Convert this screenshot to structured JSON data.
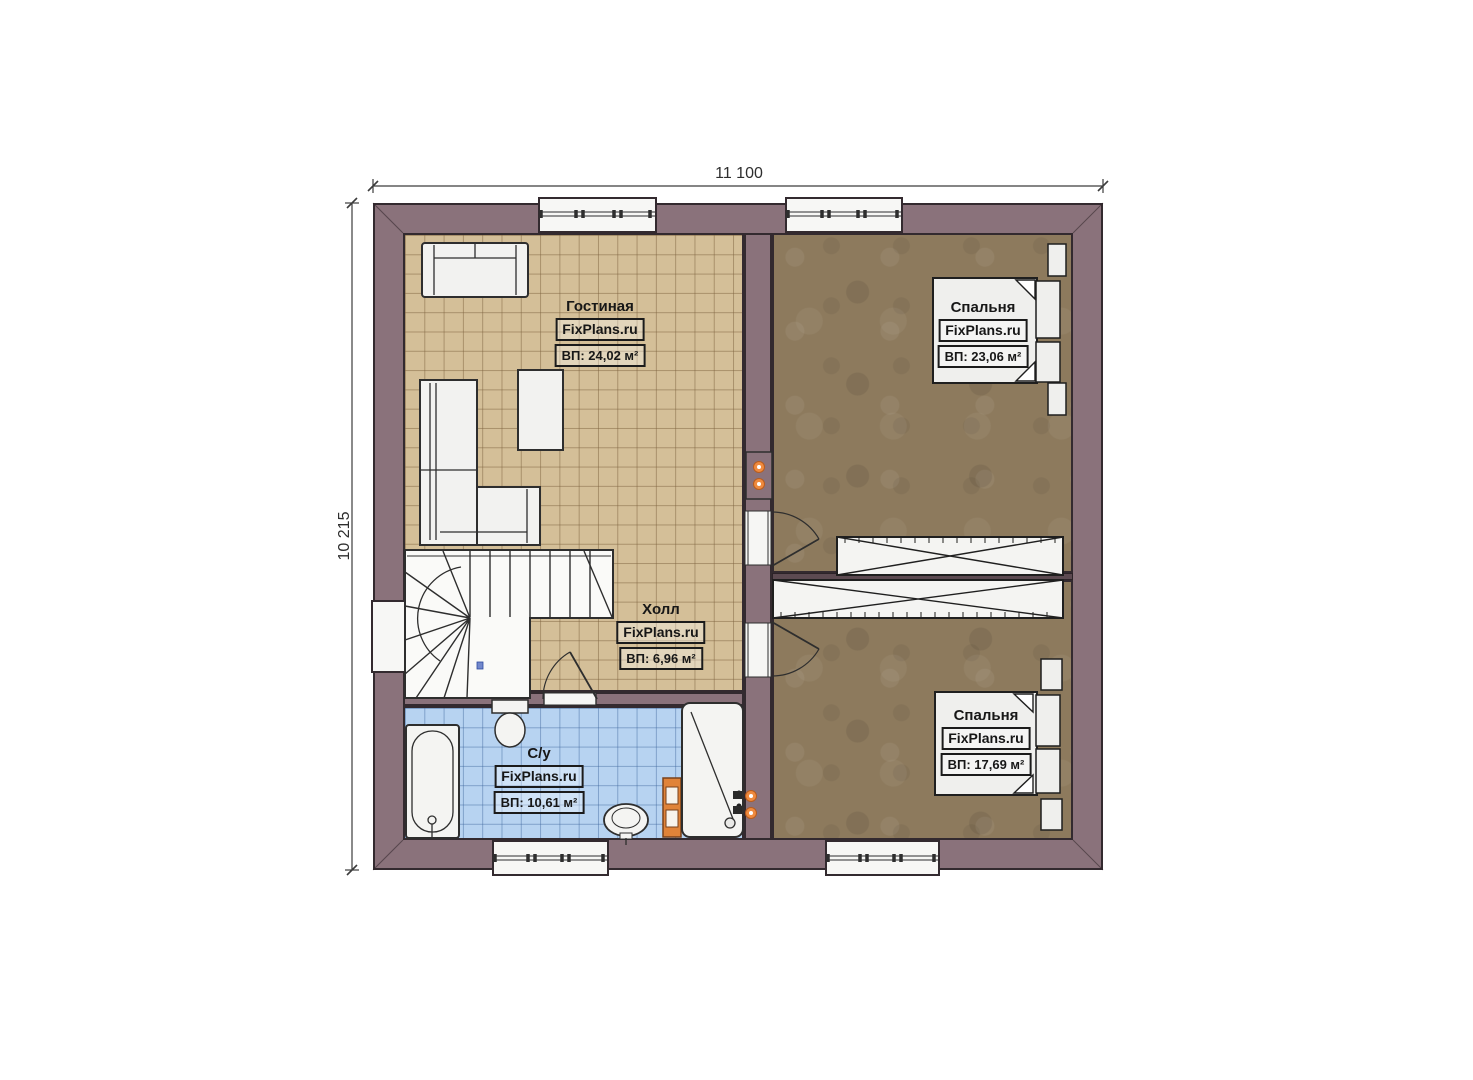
{
  "plan": {
    "dimension_top": "11 100",
    "dimension_left": "10 215",
    "rooms": {
      "living": {
        "name": "Гостиная",
        "brand": "FixPlans.ru",
        "area": "ВП: 24,02 м²"
      },
      "bedroom_top": {
        "name": "Спальня",
        "brand": "FixPlans.ru",
        "area": "ВП: 23,06 м²"
      },
      "hall": {
        "name": "Холл",
        "brand": "FixPlans.ru",
        "area": "ВП: 6,96 м²"
      },
      "bathroom": {
        "name": "С/у",
        "brand": "FixPlans.ru",
        "area": "ВП: 10,61 м²"
      },
      "bedroom_bottom": {
        "name": "Спальня",
        "brand": "FixPlans.ru",
        "area": "ВП: 17,69 м²"
      }
    },
    "colors": {
      "wall": "#8a727b",
      "outline": "#332a2f",
      "floor_living": "#d4bf98",
      "floor_bedroom": "#8d7a5d",
      "floor_bathroom": "#b7d3f1",
      "stair_white": "#fafaf8",
      "accent_orange": "#ef8a3e"
    }
  }
}
